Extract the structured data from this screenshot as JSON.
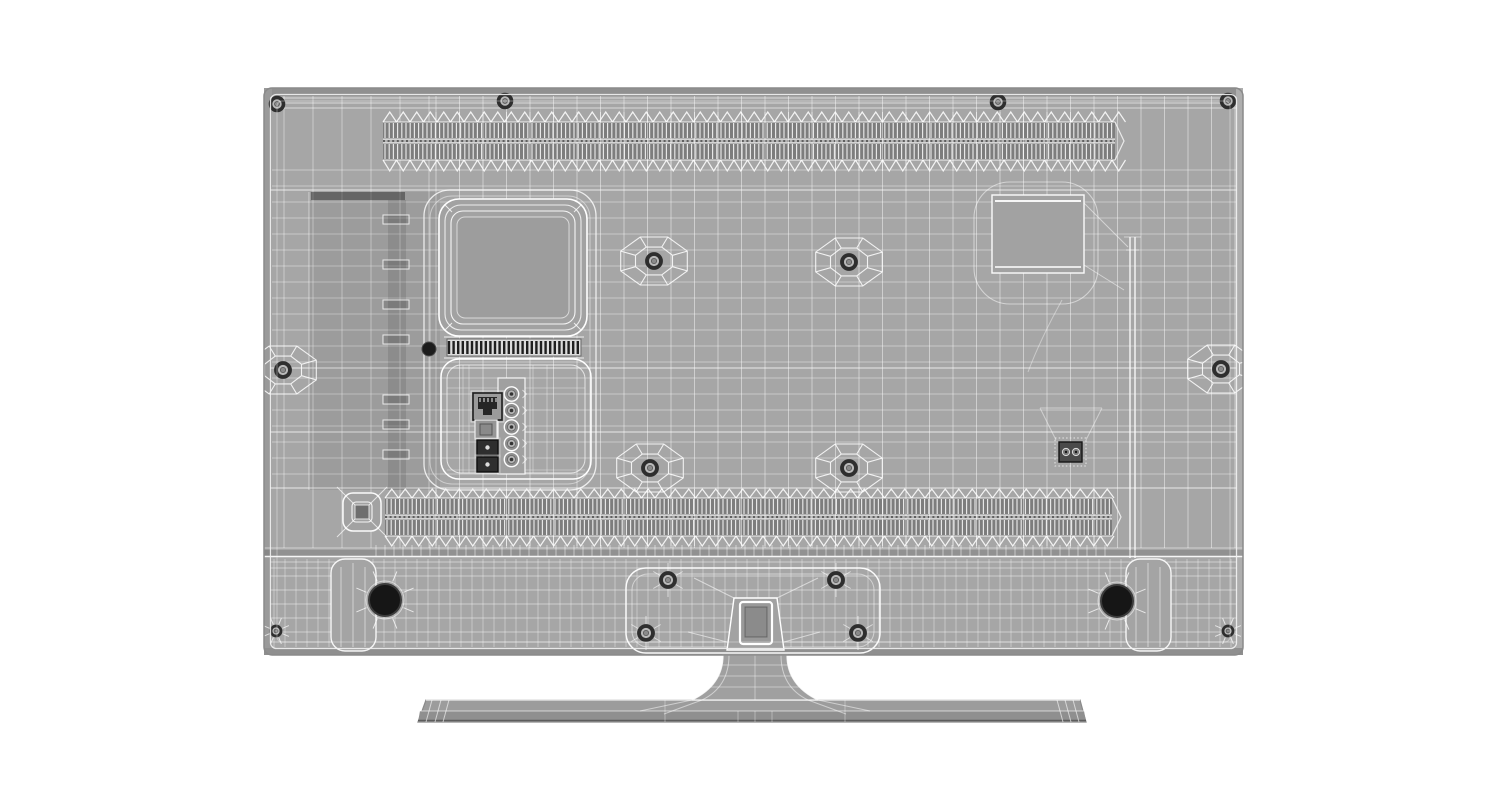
{
  "scene": {
    "description": "Rear view 3D wireframe render of a flat-screen TV on a pedestal stand",
    "render_style": "shaded gray surfaces with white polygon-mesh wireframe overlay",
    "background": "#ffffff"
  },
  "palette": {
    "body": "#a6a6a6",
    "body_edge_top": "#909090",
    "body_edge_left": "#9a9a9a",
    "body_edge_right": "#aeaeae",
    "body_edge_bottom": "#8f8f8f",
    "panel_fill": "#a2a2a2",
    "plate_fill": "#9d9d9d",
    "vent_dark": "#7d7d7d",
    "vent_sep": "#b3b3b3",
    "wire": "#ffffff",
    "dark_detail": "#242424",
    "screw_ring": "#2e2e2e",
    "stand_fill": "#a0a0a0",
    "base_top": "#9c9c9c",
    "base_front": "#8f8f8f",
    "silhouette": "#8a8a8a"
  },
  "tv": {
    "body": {
      "x": 264,
      "y": 88,
      "w": 979,
      "h": 567,
      "corner": 8
    }
  },
  "grid": {
    "verticals_sparse": {
      "x0": 284,
      "x1": 436,
      "step": 29,
      "y0": 96,
      "y1": 548
    },
    "verticals_dense": {
      "x0": 436,
      "x1": 1236,
      "step": 23.5,
      "y0": 96,
      "y1": 548
    },
    "horizontals_mid": {
      "y0": 170,
      "y1": 486,
      "step": 16,
      "x0": 272,
      "x1": 1236
    },
    "horizontals_top": [
      98,
      103,
      108
    ],
    "bright_horizontals": [
      190,
      368,
      432,
      488
    ]
  },
  "vents": {
    "top": {
      "x0": 383,
      "x1": 1115,
      "zig_top_apex": 112,
      "zig_top_base": 122,
      "row1": [
        122,
        139
      ],
      "sep": [
        139,
        143
      ],
      "row2": [
        143,
        160
      ],
      "zig_bot_base": 160,
      "zig_bot_apex": 171,
      "stripe_step": 4.2,
      "zig_step": 13.5
    },
    "bottom": {
      "x0": 385,
      "x1": 1112,
      "zig_top_apex": 489,
      "zig_top_base": 498,
      "row1": [
        498,
        515
      ],
      "sep": [
        515,
        519
      ],
      "row2": [
        519,
        536
      ],
      "zig_bot_base": 536,
      "zig_bot_apex": 546,
      "stripe_step": 4.2,
      "zig_step": 13.5
    }
  },
  "left_recess": {
    "rect": [
      309,
      192,
      131,
      298
    ],
    "shadow": [
      311,
      192,
      94,
      8
    ],
    "strip": [
      388,
      200,
      18,
      290
    ],
    "clips": [
      215,
      260,
      300,
      335,
      395,
      420,
      450
    ]
  },
  "island": {
    "outer": [
      424,
      190,
      172,
      300,
      26
    ],
    "inner": [
      430,
      196,
      160,
      288,
      22
    ]
  },
  "board_housing": {
    "outer": [
      439,
      199,
      148,
      137,
      20
    ],
    "mid": [
      445,
      205,
      136,
      125,
      16
    ],
    "inner": [
      451,
      211,
      124,
      113,
      12
    ],
    "plate": [
      457,
      217,
      112,
      101,
      8
    ]
  },
  "fin_strip": {
    "x": 447,
    "y": 339,
    "w": 134,
    "h": 17,
    "bar_step": 4.6,
    "bar_w": 2.4
  },
  "power_dot": {
    "cx": 429,
    "cy": 349,
    "r": 7
  },
  "io_panel": {
    "outer": [
      441,
      359,
      150,
      120,
      18
    ],
    "inner": [
      447,
      365,
      138,
      108,
      14
    ],
    "rca_frame": [
      498,
      378,
      27,
      96
    ],
    "rca": {
      "cx": 511.5,
      "cys": [
        394,
        410.5,
        427,
        443.5,
        459.5
      ],
      "r": 7.2
    },
    "ethernet": [
      473,
      393,
      29,
      27
    ],
    "square_port": [
      475,
      420,
      22,
      19
    ],
    "small_ports": [
      [
        477,
        440,
        21,
        15
      ],
      [
        477,
        457,
        21,
        15
      ]
    ]
  },
  "right_side": {
    "blob": [
      974,
      182,
      124,
      122,
      36
    ],
    "square": [
      992,
      195,
      92,
      78
    ],
    "rib": {
      "x": 1130,
      "gap": 5,
      "y0": 237,
      "y1": 558
    },
    "service_port": {
      "frame": [
        1055,
        438,
        31,
        28
      ],
      "body": [
        1059,
        442,
        23,
        20
      ],
      "jack_cx": [
        1066,
        1076
      ],
      "jack_cy": 452,
      "jack_r": 3.6
    }
  },
  "screws": {
    "web": [
      [
        654,
        261
      ],
      [
        849,
        262
      ],
      [
        283,
        370
      ],
      [
        1221,
        369
      ],
      [
        650,
        468
      ],
      [
        849,
        468
      ]
    ],
    "plain": [
      [
        277,
        104
      ],
      [
        505,
        101
      ],
      [
        998,
        102
      ],
      [
        1228,
        101
      ]
    ],
    "plate": [
      [
        668,
        580
      ],
      [
        836,
        580
      ],
      [
        646,
        633
      ],
      [
        858,
        633
      ]
    ],
    "corner": [
      [
        276,
        631
      ],
      [
        1228,
        631
      ]
    ],
    "speaker_holes": [
      [
        385,
        600
      ],
      [
        1117,
        601
      ]
    ]
  },
  "speaker_bar": {
    "divider_band": [
      550,
      556
    ],
    "y0": 559,
    "y1": 647,
    "v_step": 11,
    "h_lines": [
      562,
      568,
      576,
      590,
      604,
      618,
      632,
      642
    ],
    "transition": {
      "x0": 376,
      "x1": 1112,
      "y0": 545,
      "y1": 556,
      "step": 9
    },
    "tabs": [
      [
        331,
        559,
        45,
        92
      ],
      [
        1126,
        559,
        45,
        92
      ]
    ]
  },
  "button_pad": {
    "outer": [
      343,
      493,
      38,
      38,
      10
    ],
    "inner": [
      352,
      502,
      20,
      20,
      4
    ],
    "core": [
      355,
      505,
      14,
      14
    ]
  },
  "stand": {
    "plate": [
      626,
      568,
      254,
      85,
      20
    ],
    "plate_inner": [
      632,
      574,
      242,
      73,
      16
    ],
    "trapezoid": {
      "y0": 598,
      "y1": 650,
      "top": [
        734,
        777
      ],
      "bottom": [
        727,
        784
      ]
    },
    "slot": [
      740,
      602,
      32,
      42
    ],
    "hole": [
      745,
      607,
      22,
      30
    ],
    "neck": {
      "y0": 655,
      "y1": 700,
      "top": [
        723,
        787
      ],
      "bottom": [
        692,
        818
      ]
    },
    "base": {
      "top_y": 700,
      "mid_y": 711,
      "bot_y": 722,
      "top_x": [
        426,
        1080
      ],
      "bot_x": [
        418,
        1086
      ],
      "tip_left": [
        432,
        441,
        449
      ],
      "tip_right": [
        1057,
        1065,
        1073
      ]
    }
  }
}
